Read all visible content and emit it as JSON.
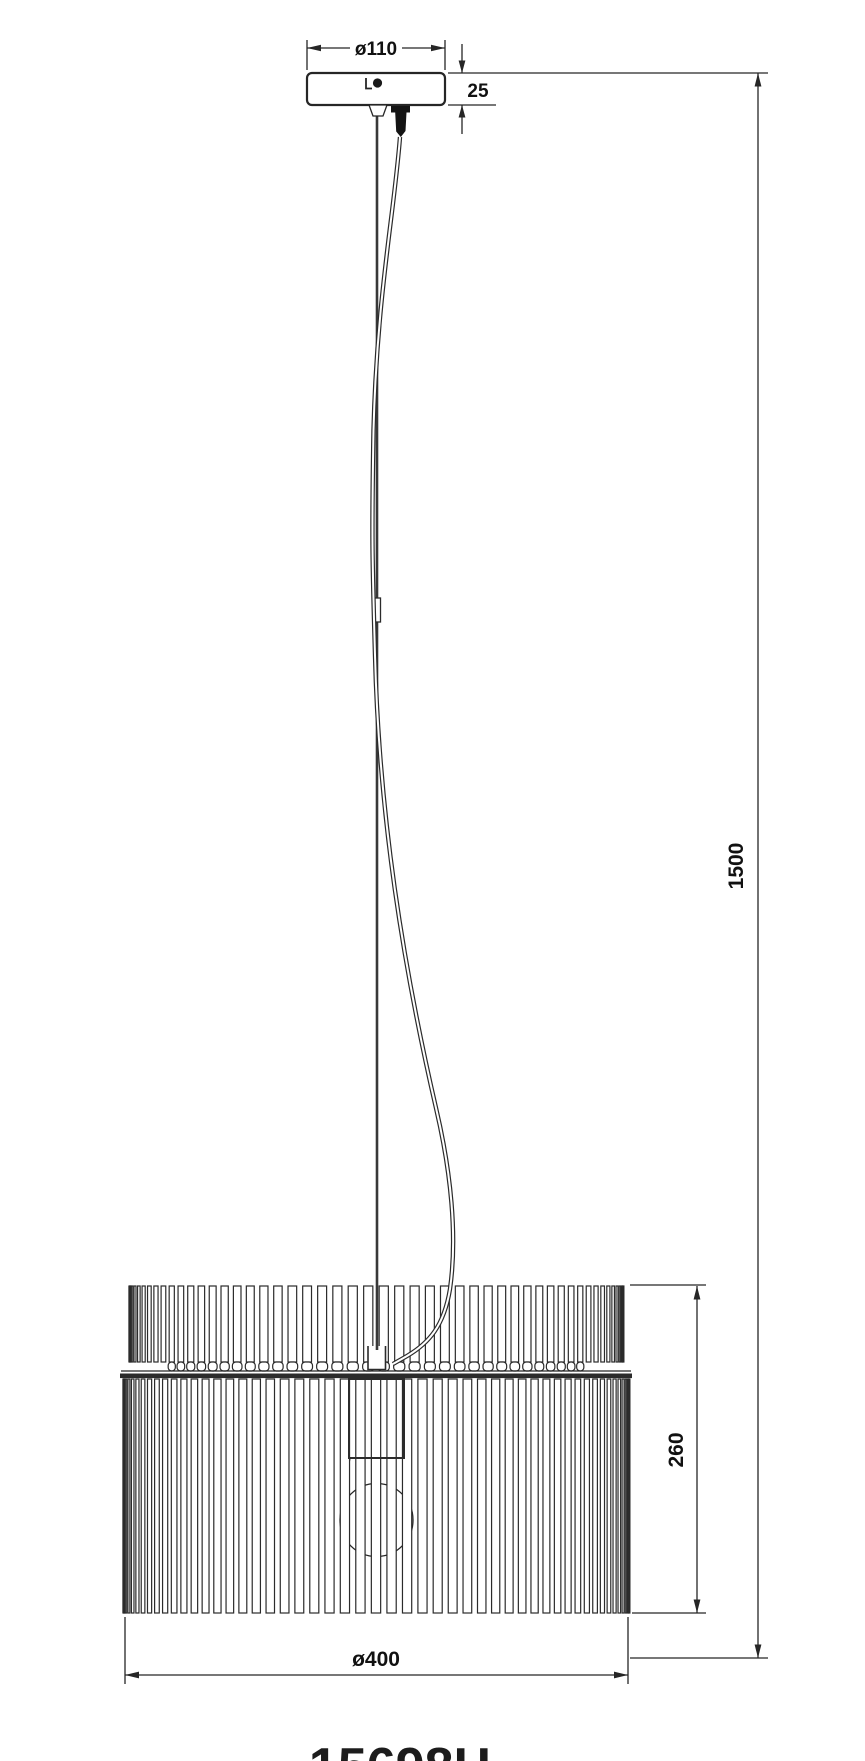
{
  "drawing": {
    "part_number": "15698H",
    "background_color": "#ffffff",
    "line_color": "#2b2b2b",
    "dimensions": {
      "canopy_diameter_label": "ø110",
      "canopy_height_label": "25",
      "overall_drop_label": "1500",
      "shade_height_label": "260",
      "shade_diameter_label": "ø400"
    }
  }
}
